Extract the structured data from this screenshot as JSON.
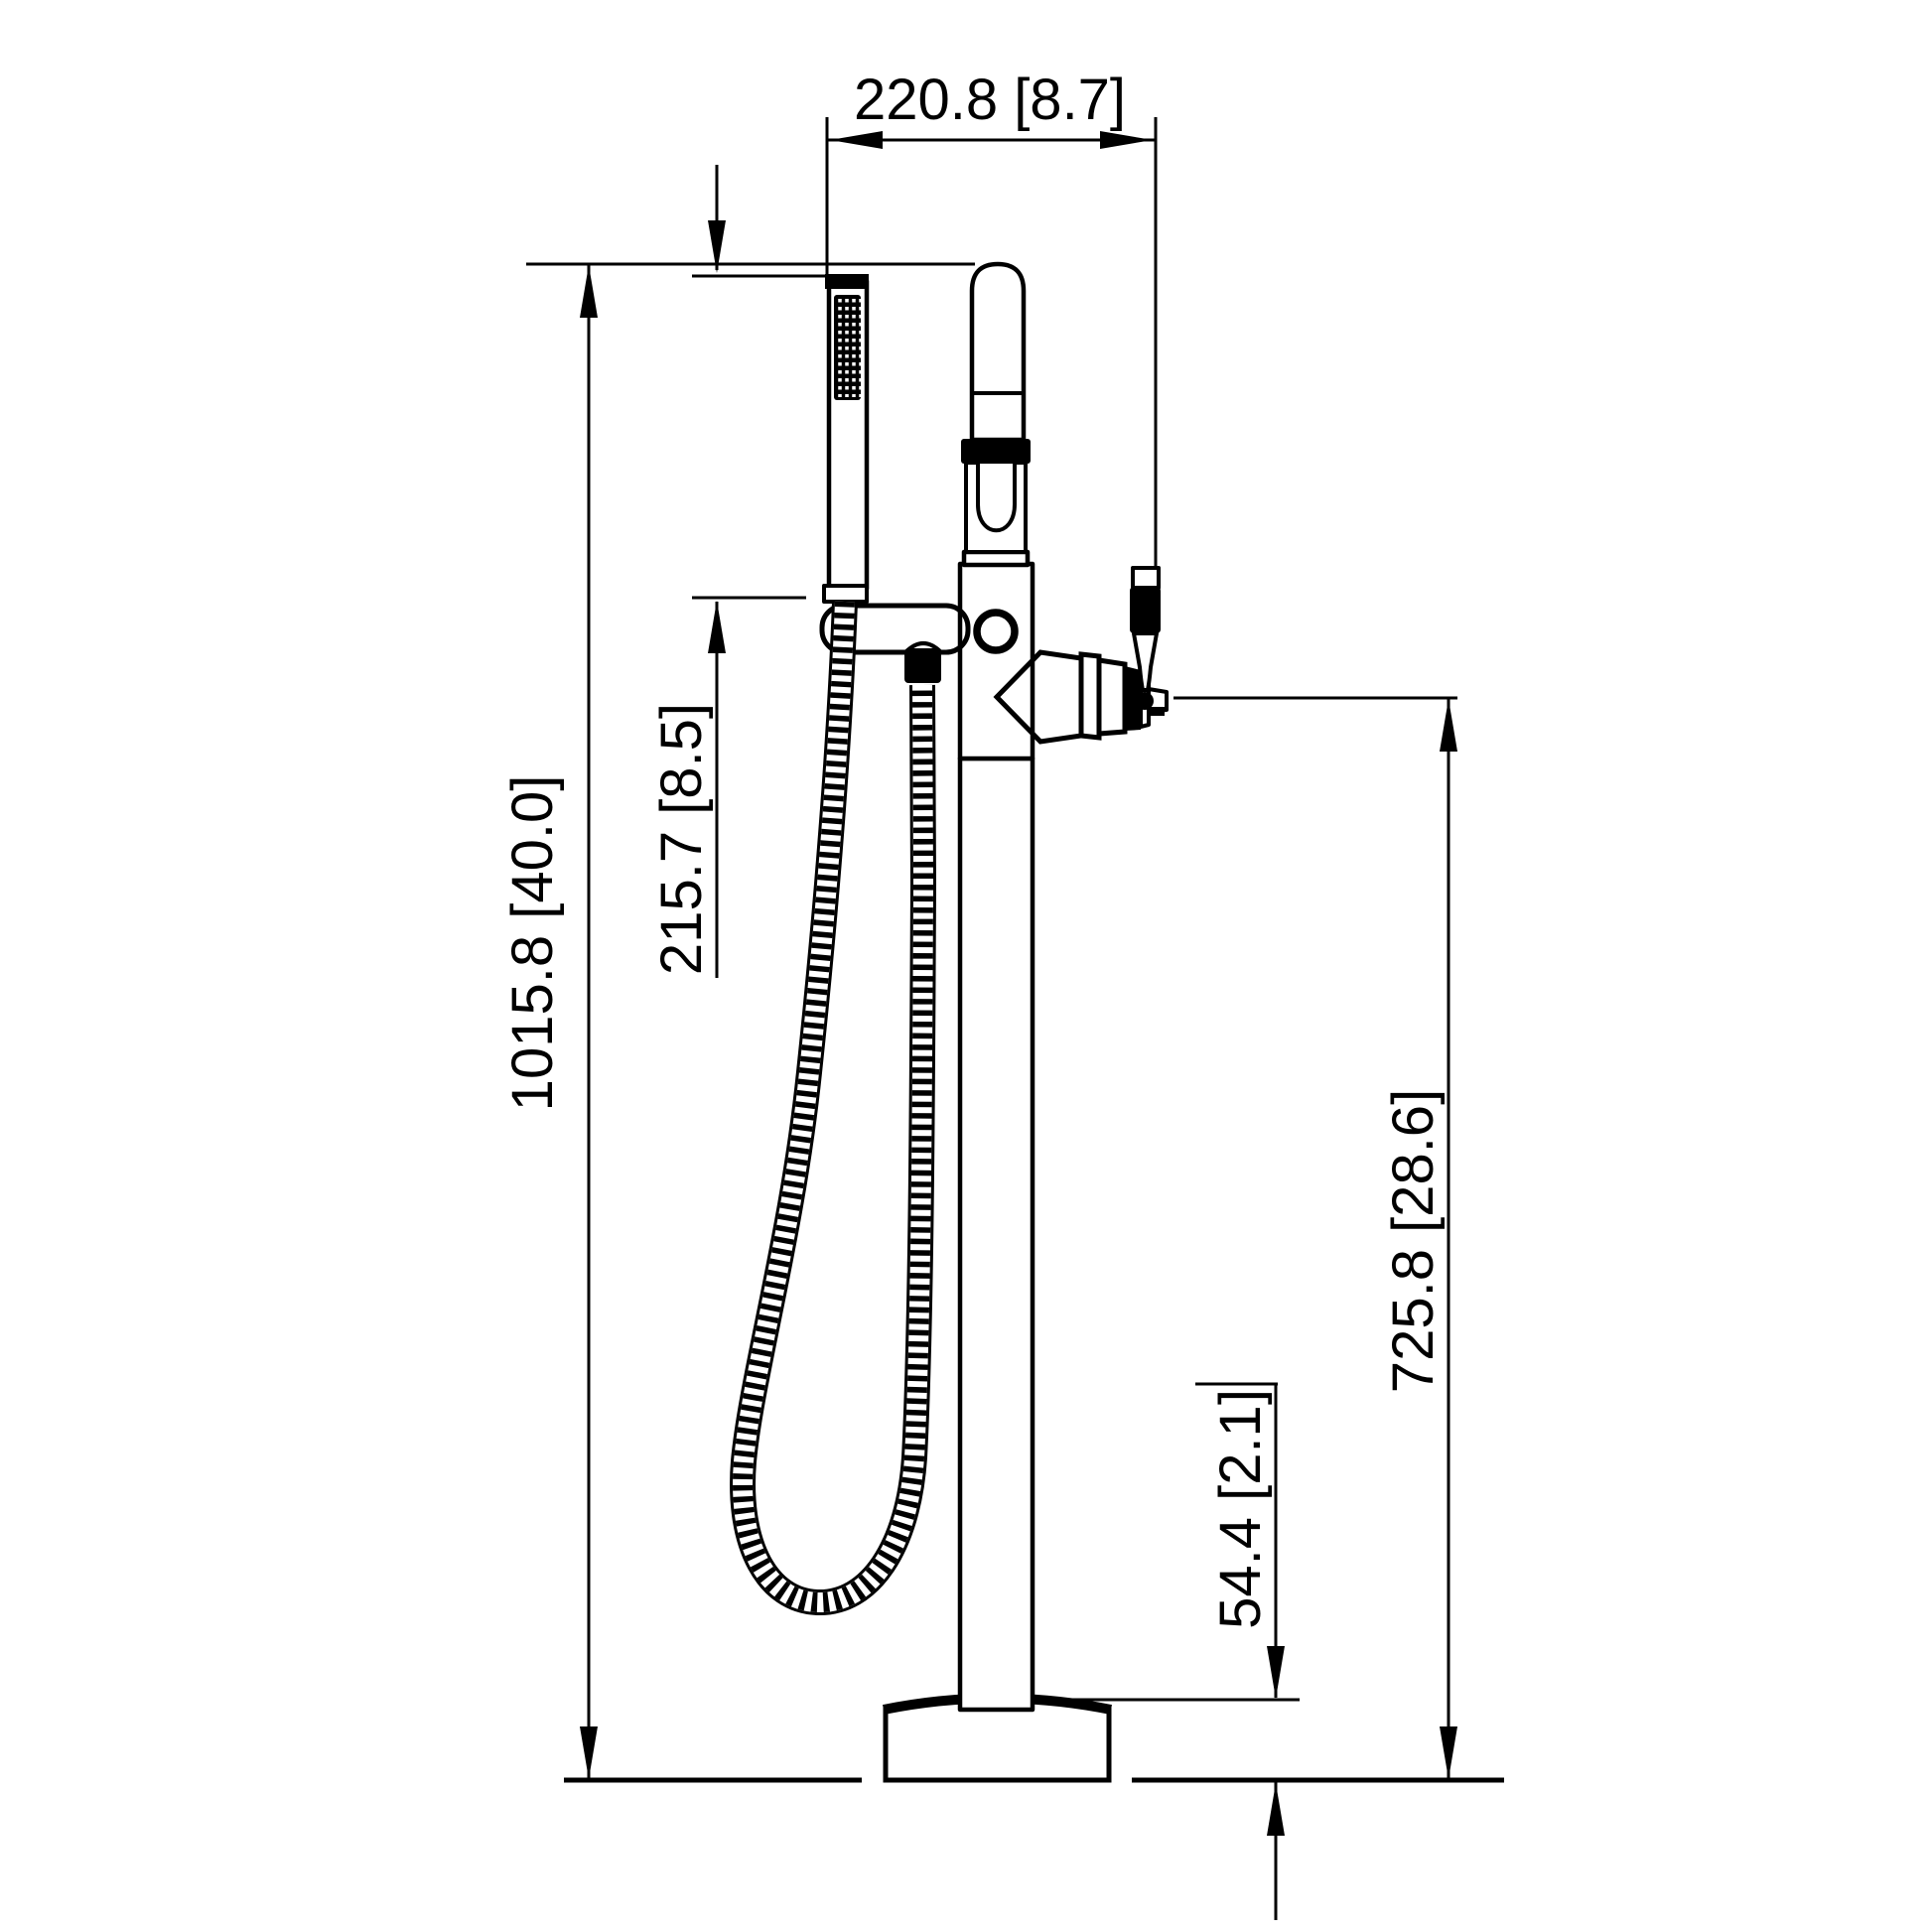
{
  "drawing": {
    "type": "technical-dimension-drawing",
    "subject": "freestanding-bathtub-faucet-with-handshower",
    "colors": {
      "line": "#000000",
      "background": "#ffffff"
    },
    "dimensions": {
      "top_width": {
        "label": "220.8 [8.7]",
        "mm": 220.8,
        "inches": 8.7,
        "orientation": "horizontal"
      },
      "total_height": {
        "label": "1015.8 [40.0]",
        "mm": 1015.8,
        "inches": 40.0,
        "orientation": "vertical"
      },
      "handshower_length": {
        "label": "215.7 [8.5]",
        "mm": 215.7,
        "inches": 8.5,
        "orientation": "vertical"
      },
      "spout_height": {
        "label": "725.8 [28.6]",
        "mm": 725.8,
        "inches": 28.6,
        "orientation": "vertical"
      },
      "base_height": {
        "label": "54.4 [2.1]",
        "mm": 54.4,
        "inches": 2.1,
        "orientation": "vertical"
      }
    },
    "components": [
      "handshower-wand",
      "handshower-holder",
      "hose-connector",
      "shower-hose",
      "riser-pipe",
      "cartridge-collar",
      "faucet-body",
      "tub-spout",
      "control-lever",
      "floor-column",
      "base-flange",
      "floor-line"
    ]
  }
}
